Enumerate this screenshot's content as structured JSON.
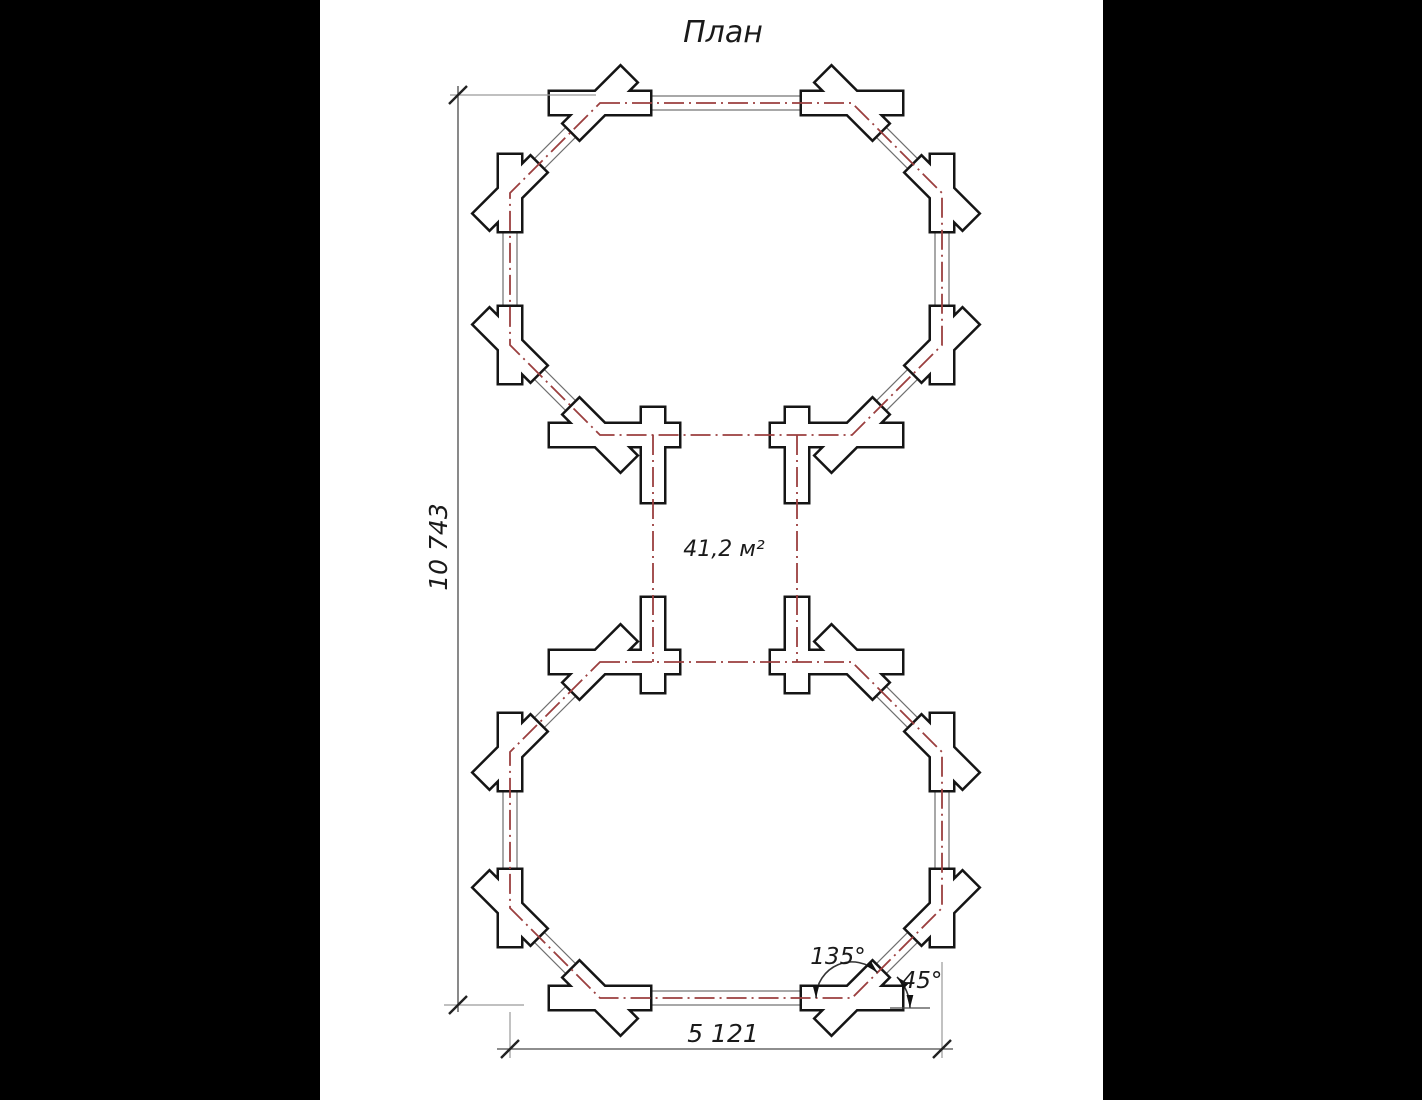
{
  "title": "План",
  "labels": {
    "area": "41,2 м²"
  },
  "dimensions": {
    "height_mm": "10 743",
    "width_mm": "5 121"
  },
  "angles": {
    "interior": "135°",
    "diagonal": "45°"
  },
  "colors": {
    "centerline_red": "#9b3f3f",
    "wall_line_gray": "#6f6f6f",
    "joint_outline_black": "#151515",
    "paper_white": "#ffffff",
    "letterbox_black": "#000000"
  }
}
